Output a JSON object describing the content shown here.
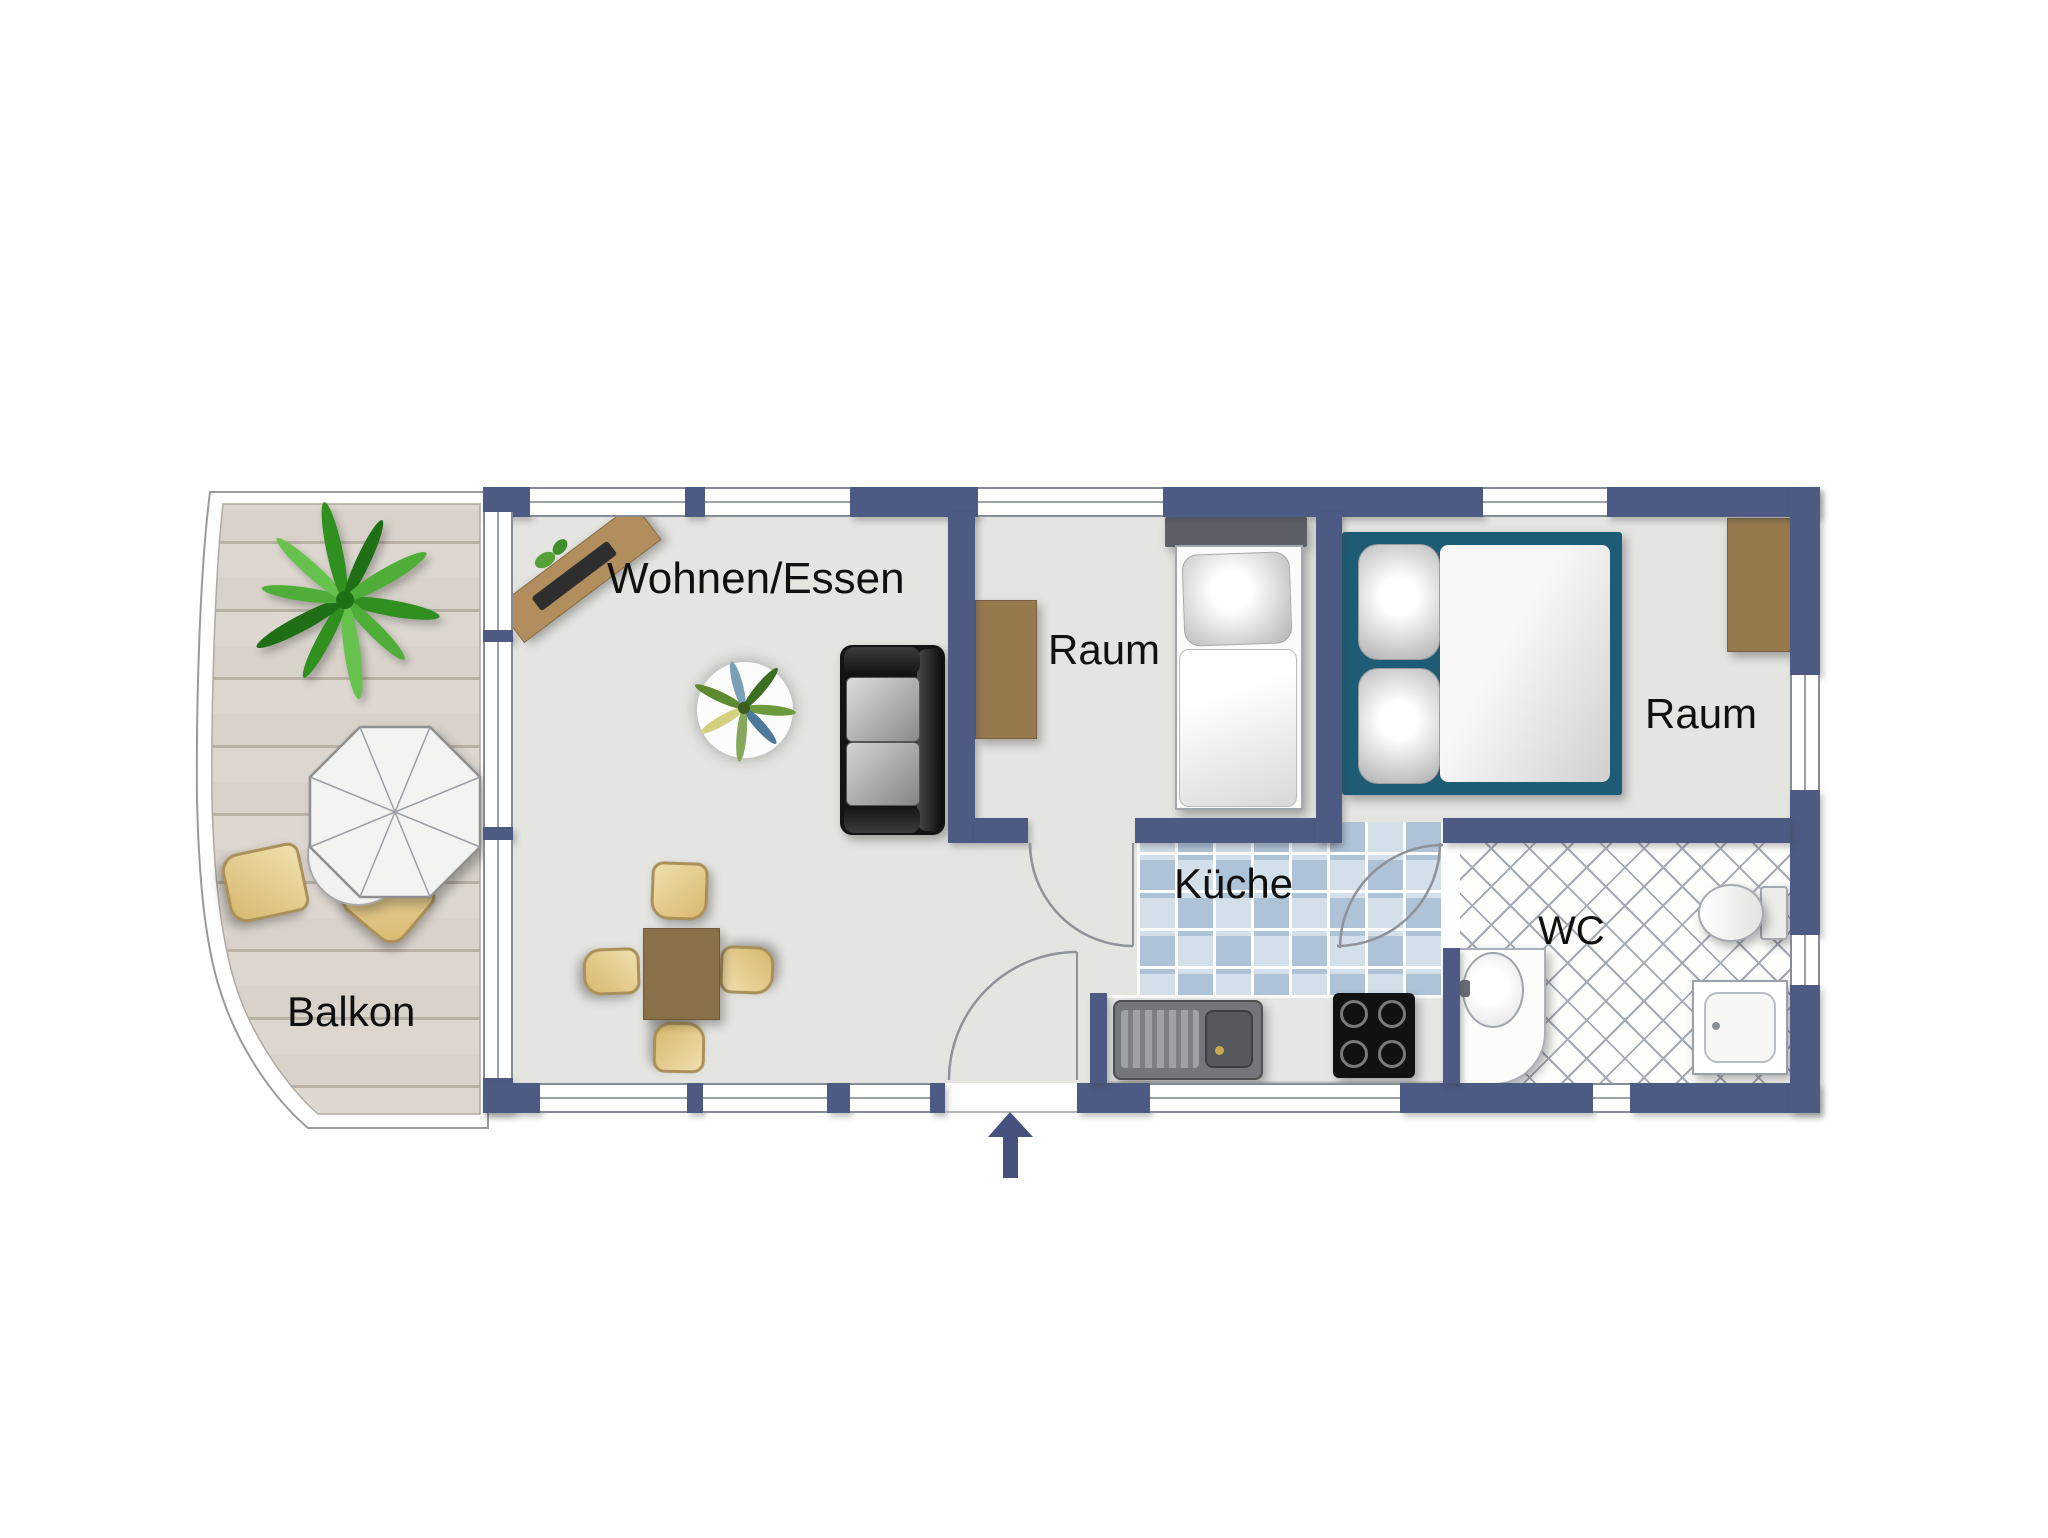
{
  "plan": {
    "type": "apartment-floor-plan",
    "rooms": [
      {
        "id": "balkon",
        "label": "Balkon"
      },
      {
        "id": "wohnen-essen",
        "label": "Wohnen/Essen"
      },
      {
        "id": "raum-1",
        "label": "Raum"
      },
      {
        "id": "raum-2",
        "label": "Raum"
      },
      {
        "id": "kueche",
        "label": "Küche"
      },
      {
        "id": "wc",
        "label": "WC"
      }
    ],
    "furniture": {
      "balkon": [
        "potted-plant",
        "parasol-table",
        "chairs"
      ],
      "wohnen-essen": [
        "sideboard",
        "round-rug-with-plant",
        "sofa",
        "dining-table",
        "dining-chairs"
      ],
      "raum-1": [
        "desk",
        "single-bed"
      ],
      "raum-2": [
        "double-bed",
        "wardrobe"
      ],
      "kueche": [
        "counter",
        "sink",
        "stove"
      ],
      "wc": [
        "washbasin-vanity",
        "toilet",
        "shower"
      ]
    },
    "entrance": {
      "symbol": "arrow-up"
    },
    "colors": {
      "wall": "#4d5a84",
      "arrow": "#46527d",
      "floor": "#e4e4e1",
      "kitchen-tile-a": "#aec3d7",
      "kitchen-tile-b": "#d3dfe9",
      "wc-tile-line": "#a4aab2",
      "deck-wood": "#d8d2ca",
      "deck-line": "#b9b0a6",
      "furniture-wood": "#97794e",
      "sideboard-wood": "#b28e5e",
      "chair-light": "#f0dfae",
      "chair-dark": "#d8b86e",
      "chair-border": "#ab905a",
      "bed-frame": "#1d5c74",
      "door-arc": "#8f9299"
    }
  }
}
